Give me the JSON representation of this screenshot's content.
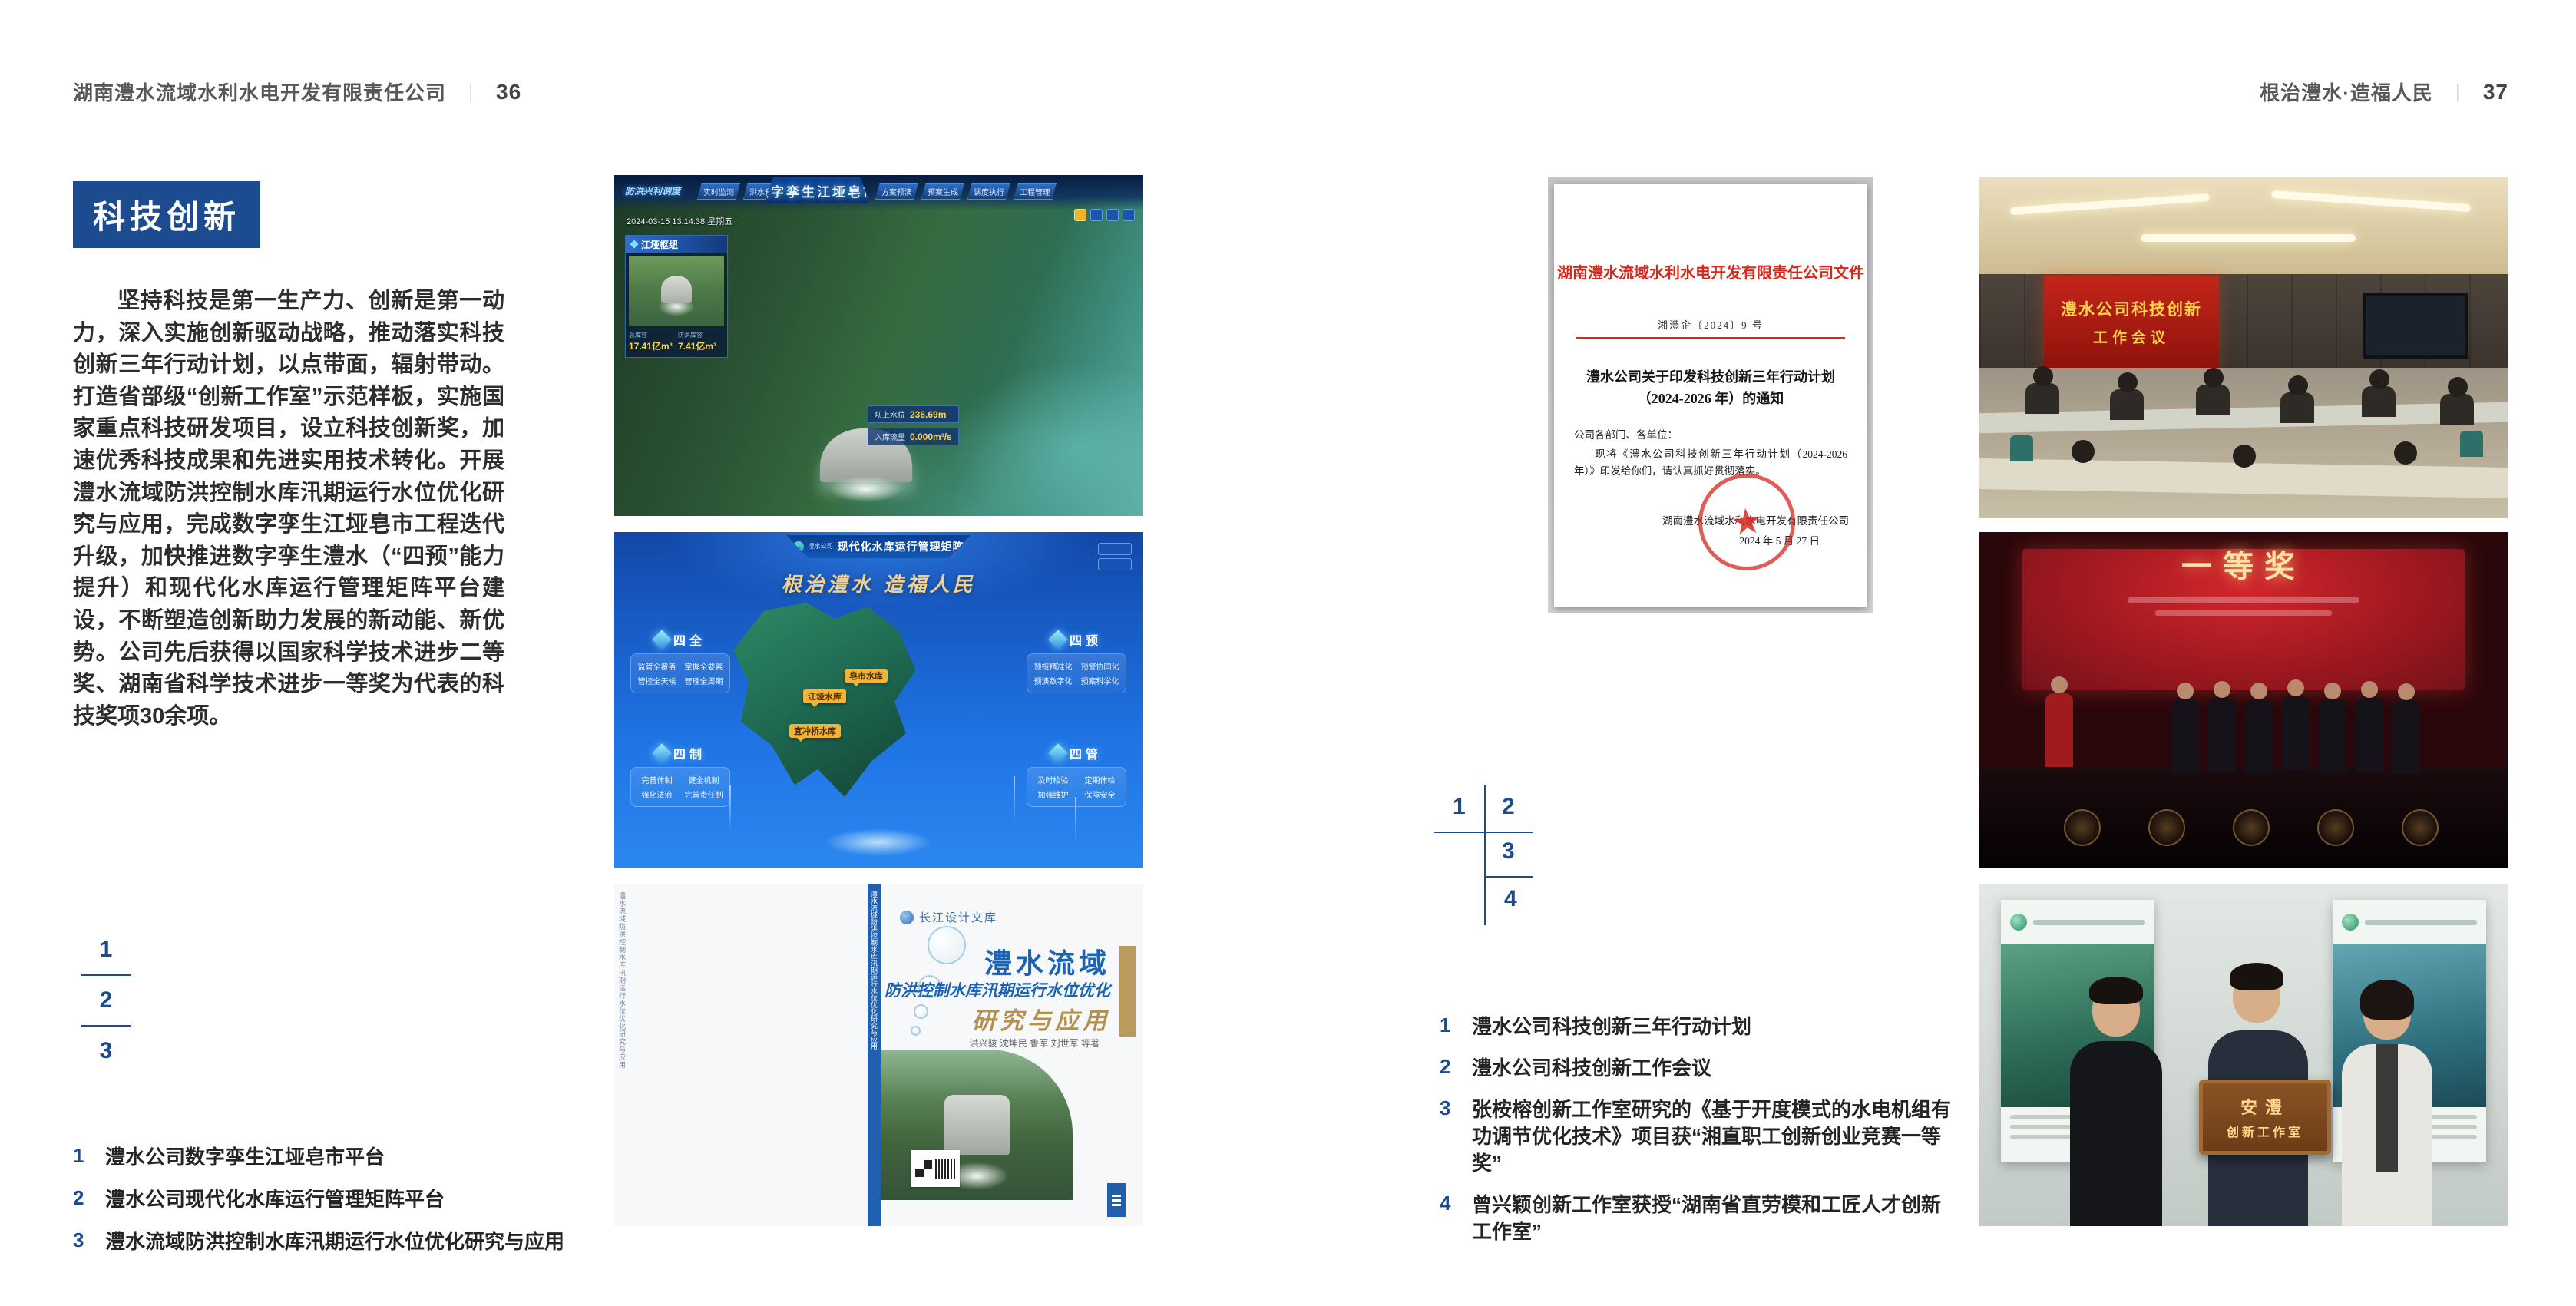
{
  "page_left": {
    "header": {
      "company": "湖南澧水流域水利水电开发有限责任公司",
      "divider": "｜",
      "page_no": "36"
    },
    "section_title": "科技创新",
    "paragraph": "坚持科技是第一生产力、创新是第一动力，深入实施创新驱动战略，推动落实科技创新三年行动计划，以点带面，辐射带动。打造省部级“创新工作室”示范样板，实施国家重点科技研发项目，设立科技创新奖，加速优秀科技成果和先进实用技术转化。开展澧水流域防洪控制水库汛期运行水位优化研究与应用，完成数字孪生江垭皂市工程迭代升级，加快推进数字孪生澧水（“四预”能力提升）和现代化水库运行管理矩阵平台建设，不断塑造创新助力发展的新动能、新优势。公司先后获得以国家科学技术进步二等奖、湖南省科学技术进步一等奖为代表的科技奖项30余项。",
    "figure_index": [
      "1",
      "2",
      "3"
    ],
    "captions": [
      {
        "num": "1",
        "text": "澧水公司数字孪生江垭皂市平台"
      },
      {
        "num": "2",
        "text": "澧水公司现代化水库运行管理矩阵平台"
      },
      {
        "num": "3",
        "text": "澧水流域防洪控制水库汛期运行水位优化研究与应用"
      }
    ],
    "fig_dashboard": {
      "title": "数字孪生江垭皂市",
      "corner_label": "防洪兴利调度",
      "tabs_left": [
        "实时监测",
        "洪水预报",
        "防洪预警"
      ],
      "tabs_right": [
        "方案预演",
        "预案生成",
        "调度执行",
        "工程管理"
      ],
      "timestamp": "2024-03-15 13:14:38 星期五",
      "panel_title": "江垭枢纽",
      "panel_stats": [
        {
          "label": "总库容",
          "value": "17.41亿m³"
        },
        {
          "label": "防洪库容",
          "value": "7.41亿m³"
        }
      ],
      "chips": [
        {
          "label": "坝上水位",
          "value": "236.69m"
        },
        {
          "label": "入库流量",
          "value": "0.000m³/s"
        }
      ]
    },
    "fig_matrix": {
      "brand": "澧水公司",
      "app_title": "现代化水库运行管理矩阵",
      "slogan": "根治澧水 造福人民",
      "panels": [
        {
          "title": "四全",
          "items": [
            "监管全覆盖",
            "掌握全要素",
            "管控全天候",
            "管理全周期"
          ]
        },
        {
          "title": "四预",
          "items": [
            "预报精准化",
            "预警协同化",
            "预演数字化",
            "预案科学化"
          ]
        },
        {
          "title": "四制",
          "items": [
            "完善体制",
            "健全机制",
            "强化法治",
            "完善责任制"
          ]
        },
        {
          "title": "四管",
          "items": [
            "及时检验",
            "定期体检",
            "加强维护",
            "保障安全"
          ]
        }
      ],
      "map_labels": [
        "江垭水库",
        "皂市水库",
        "宜冲桥水库"
      ]
    },
    "fig_book": {
      "library": "长江设计文库",
      "title_region": "澧水流域",
      "title_sub": "防洪控制水库汛期运行水位优化",
      "title_main": "研究与应用",
      "authors": "洪兴骏  沈坤民  鲁军  刘世军  等著",
      "spine": "澧水流域防洪控制水库汛期运行水位优化研究与应用"
    }
  },
  "page_right": {
    "header": {
      "motto": "根治澧水·造福人民",
      "divider": "｜",
      "page_no": "37"
    },
    "figure_index": [
      "1",
      "2",
      "3",
      "4"
    ],
    "captions": [
      {
        "num": "1",
        "text": "澧水公司科技创新三年行动计划"
      },
      {
        "num": "2",
        "text": "澧水公司科技创新工作会议"
      },
      {
        "num": "3",
        "text": "张桉榕创新工作室研究的《基于开度模式的水电机组有功调节优化技术》项目获“湘直职工创新创业竞赛一等奖”"
      },
      {
        "num": "4",
        "text": "曾兴颖创新工作室获授“湖南省直劳模和工匠人才创新工作室”"
      }
    ],
    "fig_document": {
      "letterhead": "湖南澧水流域水利水电开发有限责任公司文件",
      "doc_no": "湘澧企〔2024〕9 号",
      "title_line1": "澧水公司关于印发科技创新三年行动计划",
      "title_line2": "（2024-2026 年）的通知",
      "salutation": "公司各部门、各单位：",
      "body": "现将《澧水公司科技创新三年行动计划（2024-2026 年）》印发给你们，请认真抓好贯彻落实。",
      "signer": "湖南澧水流域水利水电开发有限责任公司",
      "date": "2024 年 5 月 27 日",
      "stamp_star": "★"
    },
    "fig_meeting": {
      "screen_line1": "澧水公司科技创新",
      "screen_line2": "工作会议"
    },
    "fig_award": {
      "banner": "一等奖"
    },
    "fig_group": {
      "plaque_line1": "安澧",
      "plaque_line2": "创新工作室"
    }
  },
  "colors": {
    "accent_blue": "#1d4b8f",
    "doc_red": "#d8281c",
    "gold": "#b3904e"
  }
}
